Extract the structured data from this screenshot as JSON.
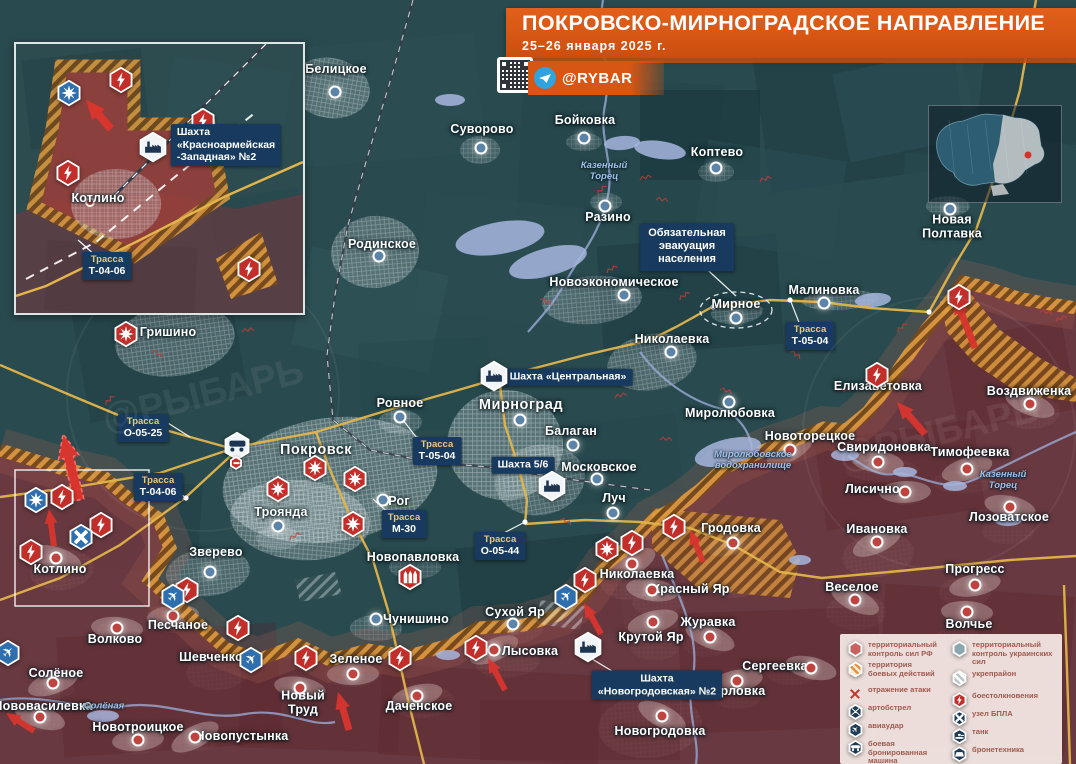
{
  "title": {
    "heading": "ПОКРОВСКО-МИРНОГРАДСКОЕ НАПРАВЛЕНИЕ",
    "date": "25–26 января 2025 г."
  },
  "branding": {
    "channel": "@RYBAR",
    "watermark": "@РЫБАРЬ"
  },
  "colors": {
    "banner": "#d85613",
    "panel_navy": "#173a5e",
    "rf_zone": "#7a343c",
    "battle_hatch": "#d98a2c",
    "road": "#e2b44a",
    "ua_dot": "#5c84a8",
    "rf_dot": "#bf4440",
    "icon_red": "#c22f2a",
    "icon_blue": "#2f6fae",
    "icon_white": "#f2f5f7",
    "glyph_navy": "#1d3550",
    "legend_bg": "#f3e7e3"
  },
  "callout": {
    "text": "Обязательная\nэвакуация\nнаселения",
    "x": 687,
    "y": 247
  },
  "inset": {
    "town": "Котлино",
    "mine": "Шахта «Красноармейская\n-Западная» №2",
    "road_t1": "Трасса",
    "road_t2": "Т-04-06"
  },
  "road_labels": [
    {
      "t1": "Трасса",
      "t2": "Т-04-06",
      "x": 158,
      "y": 487
    },
    {
      "t1": "Трасса",
      "t2": "О-05-25",
      "x": 143,
      "y": 428
    },
    {
      "t1": "Трасса",
      "t2": "Т-05-04",
      "x": 437,
      "y": 451
    },
    {
      "t1": "Трасса",
      "t2": "Т-05-04",
      "x": 810,
      "y": 336
    },
    {
      "t1": "Трасса",
      "t2": "М-30",
      "x": 404,
      "y": 524
    },
    {
      "t1": "Трасса",
      "t2": "О-05-44",
      "x": 500,
      "y": 546
    }
  ],
  "mine_labels": [
    {
      "text": "Шахта «Центральная»",
      "x": 568,
      "y": 377
    },
    {
      "text": "Шахта 5/6",
      "x": 523,
      "y": 465
    },
    {
      "text": "Шахта\n«Новогродовская» №2",
      "x": 657,
      "y": 685
    }
  ],
  "river_labels": [
    {
      "text": "Казенный\nТорец",
      "x": 604,
      "y": 172
    },
    {
      "text": "Казенный\nТорец",
      "x": 1003,
      "y": 481
    },
    {
      "text": "Миролюбовское\nводохранилище",
      "x": 753,
      "y": 461
    },
    {
      "text": "Солёная",
      "x": 104,
      "y": 707
    }
  ],
  "places": [
    {
      "n": "Белицкое",
      "x": 336,
      "y": 70,
      "d": [
        335,
        92
      ],
      "s": "ua"
    },
    {
      "n": "Суворово",
      "x": 482,
      "y": 130,
      "d": [
        481,
        148
      ],
      "s": "ua"
    },
    {
      "n": "Бойковка",
      "x": 585,
      "y": 121,
      "d": [
        584,
        138
      ],
      "s": "ua"
    },
    {
      "n": "Коптево",
      "x": 717,
      "y": 153,
      "d": [
        716,
        168
      ],
      "s": "ua"
    },
    {
      "n": "Разино",
      "x": 608,
      "y": 218,
      "d": [
        605,
        206
      ],
      "s": "ua"
    },
    {
      "n": "Родинское",
      "x": 382,
      "y": 245,
      "d": [
        379,
        256
      ],
      "s": "ua"
    },
    {
      "n": "Новоэкономическое",
      "x": 614,
      "y": 283,
      "d": [
        624,
        295
      ],
      "s": "ua"
    },
    {
      "n": "Мирное",
      "x": 736,
      "y": 305,
      "d": [
        736,
        318
      ],
      "s": "ua"
    },
    {
      "n": "Малиновка",
      "x": 824,
      "y": 291,
      "d": [
        824,
        303
      ],
      "s": "ua"
    },
    {
      "n": "Николаевка",
      "x": 672,
      "y": 340,
      "d": [
        671,
        352
      ],
      "s": "ua"
    },
    {
      "n": "Новая\nПолтавка",
      "x": 952,
      "y": 227,
      "d": [
        950,
        209
      ],
      "s": "ua"
    },
    {
      "n": "Гришино",
      "x": 168,
      "y": 333,
      "s": "ua"
    },
    {
      "n": "Ровное",
      "x": 400,
      "y": 404,
      "d": [
        400,
        417
      ],
      "s": "ua"
    },
    {
      "n": "Мирноград",
      "x": 521,
      "y": 406,
      "d": [
        520,
        420
      ],
      "s": "ua",
      "b": 1
    },
    {
      "n": "Покровск",
      "x": 316,
      "y": 451,
      "s": "ua",
      "b": 1
    },
    {
      "n": "Балаган",
      "x": 571,
      "y": 432,
      "d": [
        573,
        445
      ],
      "s": "ua"
    },
    {
      "n": "Московское",
      "x": 599,
      "y": 468,
      "d": [
        597,
        479
      ],
      "s": "ua"
    },
    {
      "n": "Луч",
      "x": 614,
      "y": 499,
      "d": [
        613,
        513
      ],
      "s": "ua"
    },
    {
      "n": "Миролюбовка",
      "x": 730,
      "y": 414,
      "d": [
        729,
        402
      ],
      "s": "ua"
    },
    {
      "n": "Рог",
      "x": 399,
      "y": 502,
      "d": [
        383,
        500
      ],
      "s": "ua"
    },
    {
      "n": "Троянда",
      "x": 281,
      "y": 513,
      "d": [
        278,
        526
      ],
      "s": "ua"
    },
    {
      "n": "Новоторецкое",
      "x": 810,
      "y": 437,
      "d": [
        790,
        450
      ],
      "s": "ru"
    },
    {
      "n": "Елизаветовка",
      "x": 878,
      "y": 387,
      "s": "ua"
    },
    {
      "n": "Свиридоновка",
      "x": 884,
      "y": 448,
      "d": [
        878,
        462
      ],
      "s": "ru"
    },
    {
      "n": "Тимофеевка",
      "x": 970,
      "y": 453,
      "d": [
        967,
        469
      ],
      "s": "ru"
    },
    {
      "n": "Воздвиженка",
      "x": 1029,
      "y": 392,
      "d": [
        1030,
        404
      ],
      "s": "ru"
    },
    {
      "n": "Лисичное",
      "x": 876,
      "y": 490,
      "d": [
        905,
        492
      ],
      "s": "ru"
    },
    {
      "n": "Ивановка",
      "x": 877,
      "y": 530,
      "d": [
        877,
        542
      ],
      "s": "ru"
    },
    {
      "n": "Лозоватское",
      "x": 1009,
      "y": 518,
      "d": [
        1010,
        507
      ],
      "s": "ru"
    },
    {
      "n": "Прогресс",
      "x": 975,
      "y": 570,
      "d": [
        975,
        585
      ],
      "s": "ru"
    },
    {
      "n": "Веселое",
      "x": 852,
      "y": 588,
      "d": [
        855,
        600
      ],
      "s": "ru"
    },
    {
      "n": "Волчье",
      "x": 969,
      "y": 625,
      "d": [
        967,
        612
      ],
      "s": "ru"
    },
    {
      "n": "Гродовка",
      "x": 731,
      "y": 529,
      "d": [
        733,
        543
      ],
      "s": "ru"
    },
    {
      "n": "Зверево",
      "x": 216,
      "y": 553,
      "d": [
        210,
        572
      ],
      "s": "ua"
    },
    {
      "n": "Новопавловка",
      "x": 413,
      "y": 558,
      "s": "ua"
    },
    {
      "n": "Котлино",
      "x": 60,
      "y": 570,
      "d": [
        56,
        558
      ],
      "s": "ru"
    },
    {
      "n": "Песчаное",
      "x": 178,
      "y": 626,
      "d": [
        173,
        616
      ],
      "s": "ru"
    },
    {
      "n": "Сухой Яр",
      "x": 515,
      "y": 613,
      "d": [
        513,
        624
      ],
      "s": "ua"
    },
    {
      "n": "Николаевка",
      "x": 637,
      "y": 575,
      "d": [
        632,
        564
      ],
      "s": "ru"
    },
    {
      "n": "Красный Яр",
      "x": 691,
      "y": 590,
      "d": [
        652,
        590
      ],
      "s": "ru"
    },
    {
      "n": "Чунишино",
      "x": 416,
      "y": 620,
      "d": [
        376,
        619
      ],
      "s": "ua"
    },
    {
      "n": "Крутой Яр",
      "x": 651,
      "y": 638,
      "d": [
        653,
        622
      ],
      "s": "ru"
    },
    {
      "n": "Журавка",
      "x": 708,
      "y": 623,
      "d": [
        710,
        637
      ],
      "s": "ru"
    },
    {
      "n": "Зеленое",
      "x": 356,
      "y": 660,
      "d": [
        353,
        674
      ],
      "s": "ru"
    },
    {
      "n": "Лысовка",
      "x": 530,
      "y": 652,
      "d": [
        494,
        650
      ],
      "s": "ru"
    },
    {
      "n": "Сергеевка",
      "x": 775,
      "y": 667,
      "d": [
        811,
        668
      ],
      "s": "ru"
    },
    {
      "n": "Орловка",
      "x": 738,
      "y": 692,
      "d": [
        737,
        681
      ],
      "s": "ru"
    },
    {
      "n": "Новогродовка",
      "x": 660,
      "y": 732,
      "d": [
        662,
        716
      ],
      "s": "ru"
    },
    {
      "n": "Шевченко",
      "x": 211,
      "y": 658,
      "s": "ru"
    },
    {
      "n": "Волково",
      "x": 115,
      "y": 640,
      "d": [
        117,
        628
      ],
      "s": "ru"
    },
    {
      "n": "Солёное",
      "x": 56,
      "y": 674,
      "d": [
        53,
        683
      ],
      "s": "ru"
    },
    {
      "n": "Нововасилевка",
      "x": 43,
      "y": 707,
      "d": [
        40,
        717
      ],
      "s": "ru"
    },
    {
      "n": "Новотроицкое",
      "x": 138,
      "y": 728,
      "d": [
        138,
        740
      ],
      "s": "ru"
    },
    {
      "n": "Новопустынка",
      "x": 242,
      "y": 737,
      "d": [
        195,
        737
      ],
      "s": "ru"
    },
    {
      "n": "Новый\nТруд",
      "x": 303,
      "y": 703,
      "d": [
        300,
        688
      ],
      "s": "ru"
    },
    {
      "n": "Даченское",
      "x": 419,
      "y": 707,
      "d": [
        417,
        696
      ],
      "s": "ru"
    }
  ],
  "icons": [
    {
      "t": "lightning",
      "x": 959,
      "y": 297
    },
    {
      "t": "lightning",
      "x": 877,
      "y": 375
    },
    {
      "t": "lightning",
      "x": 62,
      "y": 497
    },
    {
      "t": "lightning",
      "x": 101,
      "y": 525
    },
    {
      "t": "lightning",
      "x": 31,
      "y": 552
    },
    {
      "t": "lightning",
      "x": 187,
      "y": 590
    },
    {
      "t": "lightning",
      "x": 238,
      "y": 628
    },
    {
      "t": "lightning",
      "x": 306,
      "y": 658
    },
    {
      "t": "lightning",
      "x": 400,
      "y": 658
    },
    {
      "t": "lightning",
      "x": 476,
      "y": 648
    },
    {
      "t": "lightning",
      "x": 674,
      "y": 527
    },
    {
      "t": "lightning",
      "x": 632,
      "y": 543
    },
    {
      "t": "lightning",
      "x": 585,
      "y": 580
    },
    {
      "t": "burst-red",
      "x": 126,
      "y": 334
    },
    {
      "t": "burst-red",
      "x": 315,
      "y": 468
    },
    {
      "t": "burst-red",
      "x": 355,
      "y": 479
    },
    {
      "t": "burst-red",
      "x": 278,
      "y": 489
    },
    {
      "t": "burst-red",
      "x": 353,
      "y": 524
    },
    {
      "t": "burst-red",
      "x": 607,
      "y": 549
    },
    {
      "t": "burst-blue",
      "x": 36,
      "y": 500
    },
    {
      "t": "plane",
      "x": 251,
      "y": 660
    },
    {
      "t": "plane",
      "x": 8,
      "y": 653
    },
    {
      "t": "plane",
      "x": 173,
      "y": 597
    },
    {
      "t": "plane",
      "x": 566,
      "y": 597
    },
    {
      "t": "drone",
      "x": 81,
      "y": 537
    },
    {
      "t": "mlrs",
      "x": 410,
      "y": 577
    },
    {
      "t": "truck",
      "x": 237,
      "y": 446
    },
    {
      "t": "alert",
      "x": 236,
      "y": 463
    },
    {
      "t": "factory",
      "x": 494,
      "y": 376
    },
    {
      "t": "factory",
      "x": 552,
      "y": 486
    },
    {
      "t": "factory",
      "x": 588,
      "y": 647
    }
  ],
  "inset_icons": [
    {
      "t": "lightning",
      "x": 105,
      "y": 36
    },
    {
      "t": "burst-blue",
      "x": 53,
      "y": 49
    },
    {
      "t": "lightning",
      "x": 187,
      "y": 77
    },
    {
      "t": "lightning",
      "x": 52,
      "y": 129
    },
    {
      "t": "lightning",
      "x": 233,
      "y": 225
    },
    {
      "t": "factory",
      "x": 137,
      "y": 103
    }
  ],
  "legend": {
    "left": [
      {
        "icon": "hex-solid-red",
        "label": "территориальный\nконтроль сил РФ"
      },
      {
        "icon": "hex-hatch-orange",
        "label": "территория\nбоевых действий"
      },
      {
        "icon": "x-red",
        "label": "отражение атаки"
      },
      {
        "icon": "hex-art",
        "label": "артобстрел"
      },
      {
        "icon": "hex-avia",
        "label": "авиаудар"
      },
      {
        "icon": "hex-bbm",
        "label": "боевая бронированная\nмашина"
      }
    ],
    "right": [
      {
        "icon": "hex-solid-blue",
        "label": "территориальный\nконтроль украинских сил"
      },
      {
        "icon": "hex-hatch-white",
        "label": "укрепрайон"
      },
      {
        "icon": "hex-clash",
        "label": "боестолкновения"
      },
      {
        "icon": "hex-bpla",
        "label": "узел БПЛА"
      },
      {
        "icon": "hex-tank",
        "label": "танк"
      },
      {
        "icon": "hex-btech",
        "label": "бронетехника"
      }
    ]
  }
}
